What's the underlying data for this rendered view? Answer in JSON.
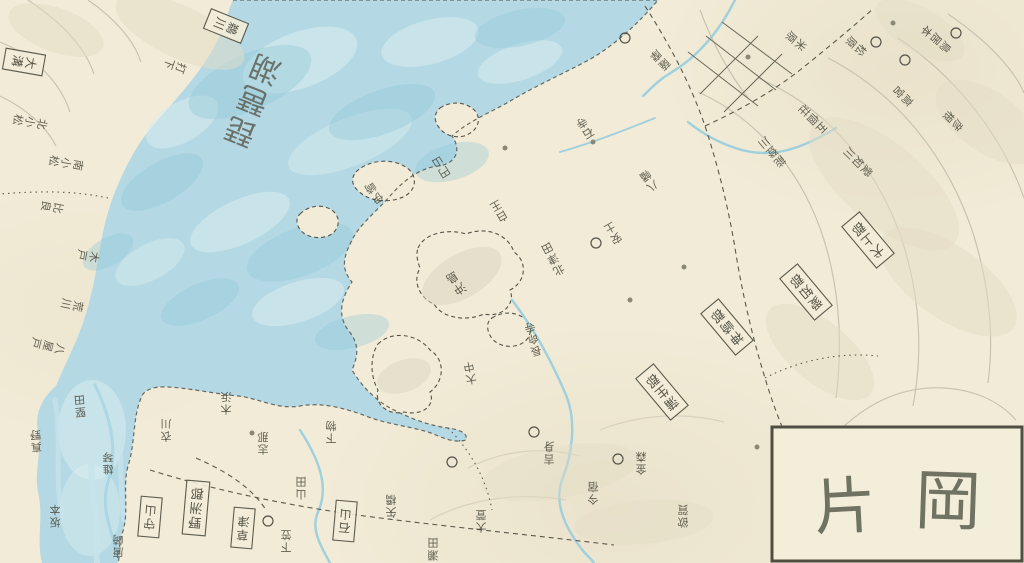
{
  "map": {
    "lake_label": "琵琶湖",
    "title": {
      "left_char": "片",
      "right_char": "岡"
    },
    "district_boxes": [
      {
        "label": "野洲郡"
      },
      {
        "label": "蒲生郡"
      },
      {
        "label": "神崎郡"
      },
      {
        "label": "犬上郡"
      },
      {
        "label": "愛知郡"
      },
      {
        "label": "守山"
      },
      {
        "label": "草津"
      },
      {
        "label": "石山"
      },
      {
        "label": "鵜川"
      },
      {
        "label": "大溝"
      }
    ],
    "places": [
      {
        "text": "打下"
      },
      {
        "text": "北小松"
      },
      {
        "text": "南小松"
      },
      {
        "text": "比良"
      },
      {
        "text": "木戸"
      },
      {
        "text": "荒川"
      },
      {
        "text": "八屋戸"
      },
      {
        "text": "堅田"
      },
      {
        "text": "真野"
      },
      {
        "text": "雄琴"
      },
      {
        "text": "坂本"
      },
      {
        "text": "唐崎"
      },
      {
        "text": "衣川"
      },
      {
        "text": "木浜"
      },
      {
        "text": "志那"
      },
      {
        "text": "下物"
      },
      {
        "text": "山田"
      },
      {
        "text": "下笠"
      },
      {
        "text": "矢橋"
      },
      {
        "text": "瀬田"
      },
      {
        "text": "大萱"
      },
      {
        "text": "伊崎"
      },
      {
        "text": "円山"
      },
      {
        "text": "白王"
      },
      {
        "text": "北津田"
      },
      {
        "text": "沖島"
      },
      {
        "text": "長命寺"
      },
      {
        "text": "大中"
      },
      {
        "text": "安土"
      },
      {
        "text": "八幡"
      },
      {
        "text": "能登川"
      },
      {
        "text": "五個荘"
      },
      {
        "text": "愛知川"
      },
      {
        "text": "高宮"
      },
      {
        "text": "彦根"
      },
      {
        "text": "鳥居本"
      },
      {
        "text": "松原"
      },
      {
        "text": "米原"
      },
      {
        "text": "吉身"
      },
      {
        "text": "今宿"
      },
      {
        "text": "金森"
      },
      {
        "text": "欲賀"
      },
      {
        "text": "薩摩"
      },
      {
        "text": "石寺"
      }
    ],
    "colors": {
      "paper": "#f1ebd7",
      "water": "#b4d9e4",
      "water_light": "#dcedf0",
      "water_deep": "#90c7d8",
      "ink": "#4e4d40",
      "contour": "#c2bdaa",
      "hill_wash": "#e3dcc6",
      "title_ink": "#676958"
    }
  }
}
